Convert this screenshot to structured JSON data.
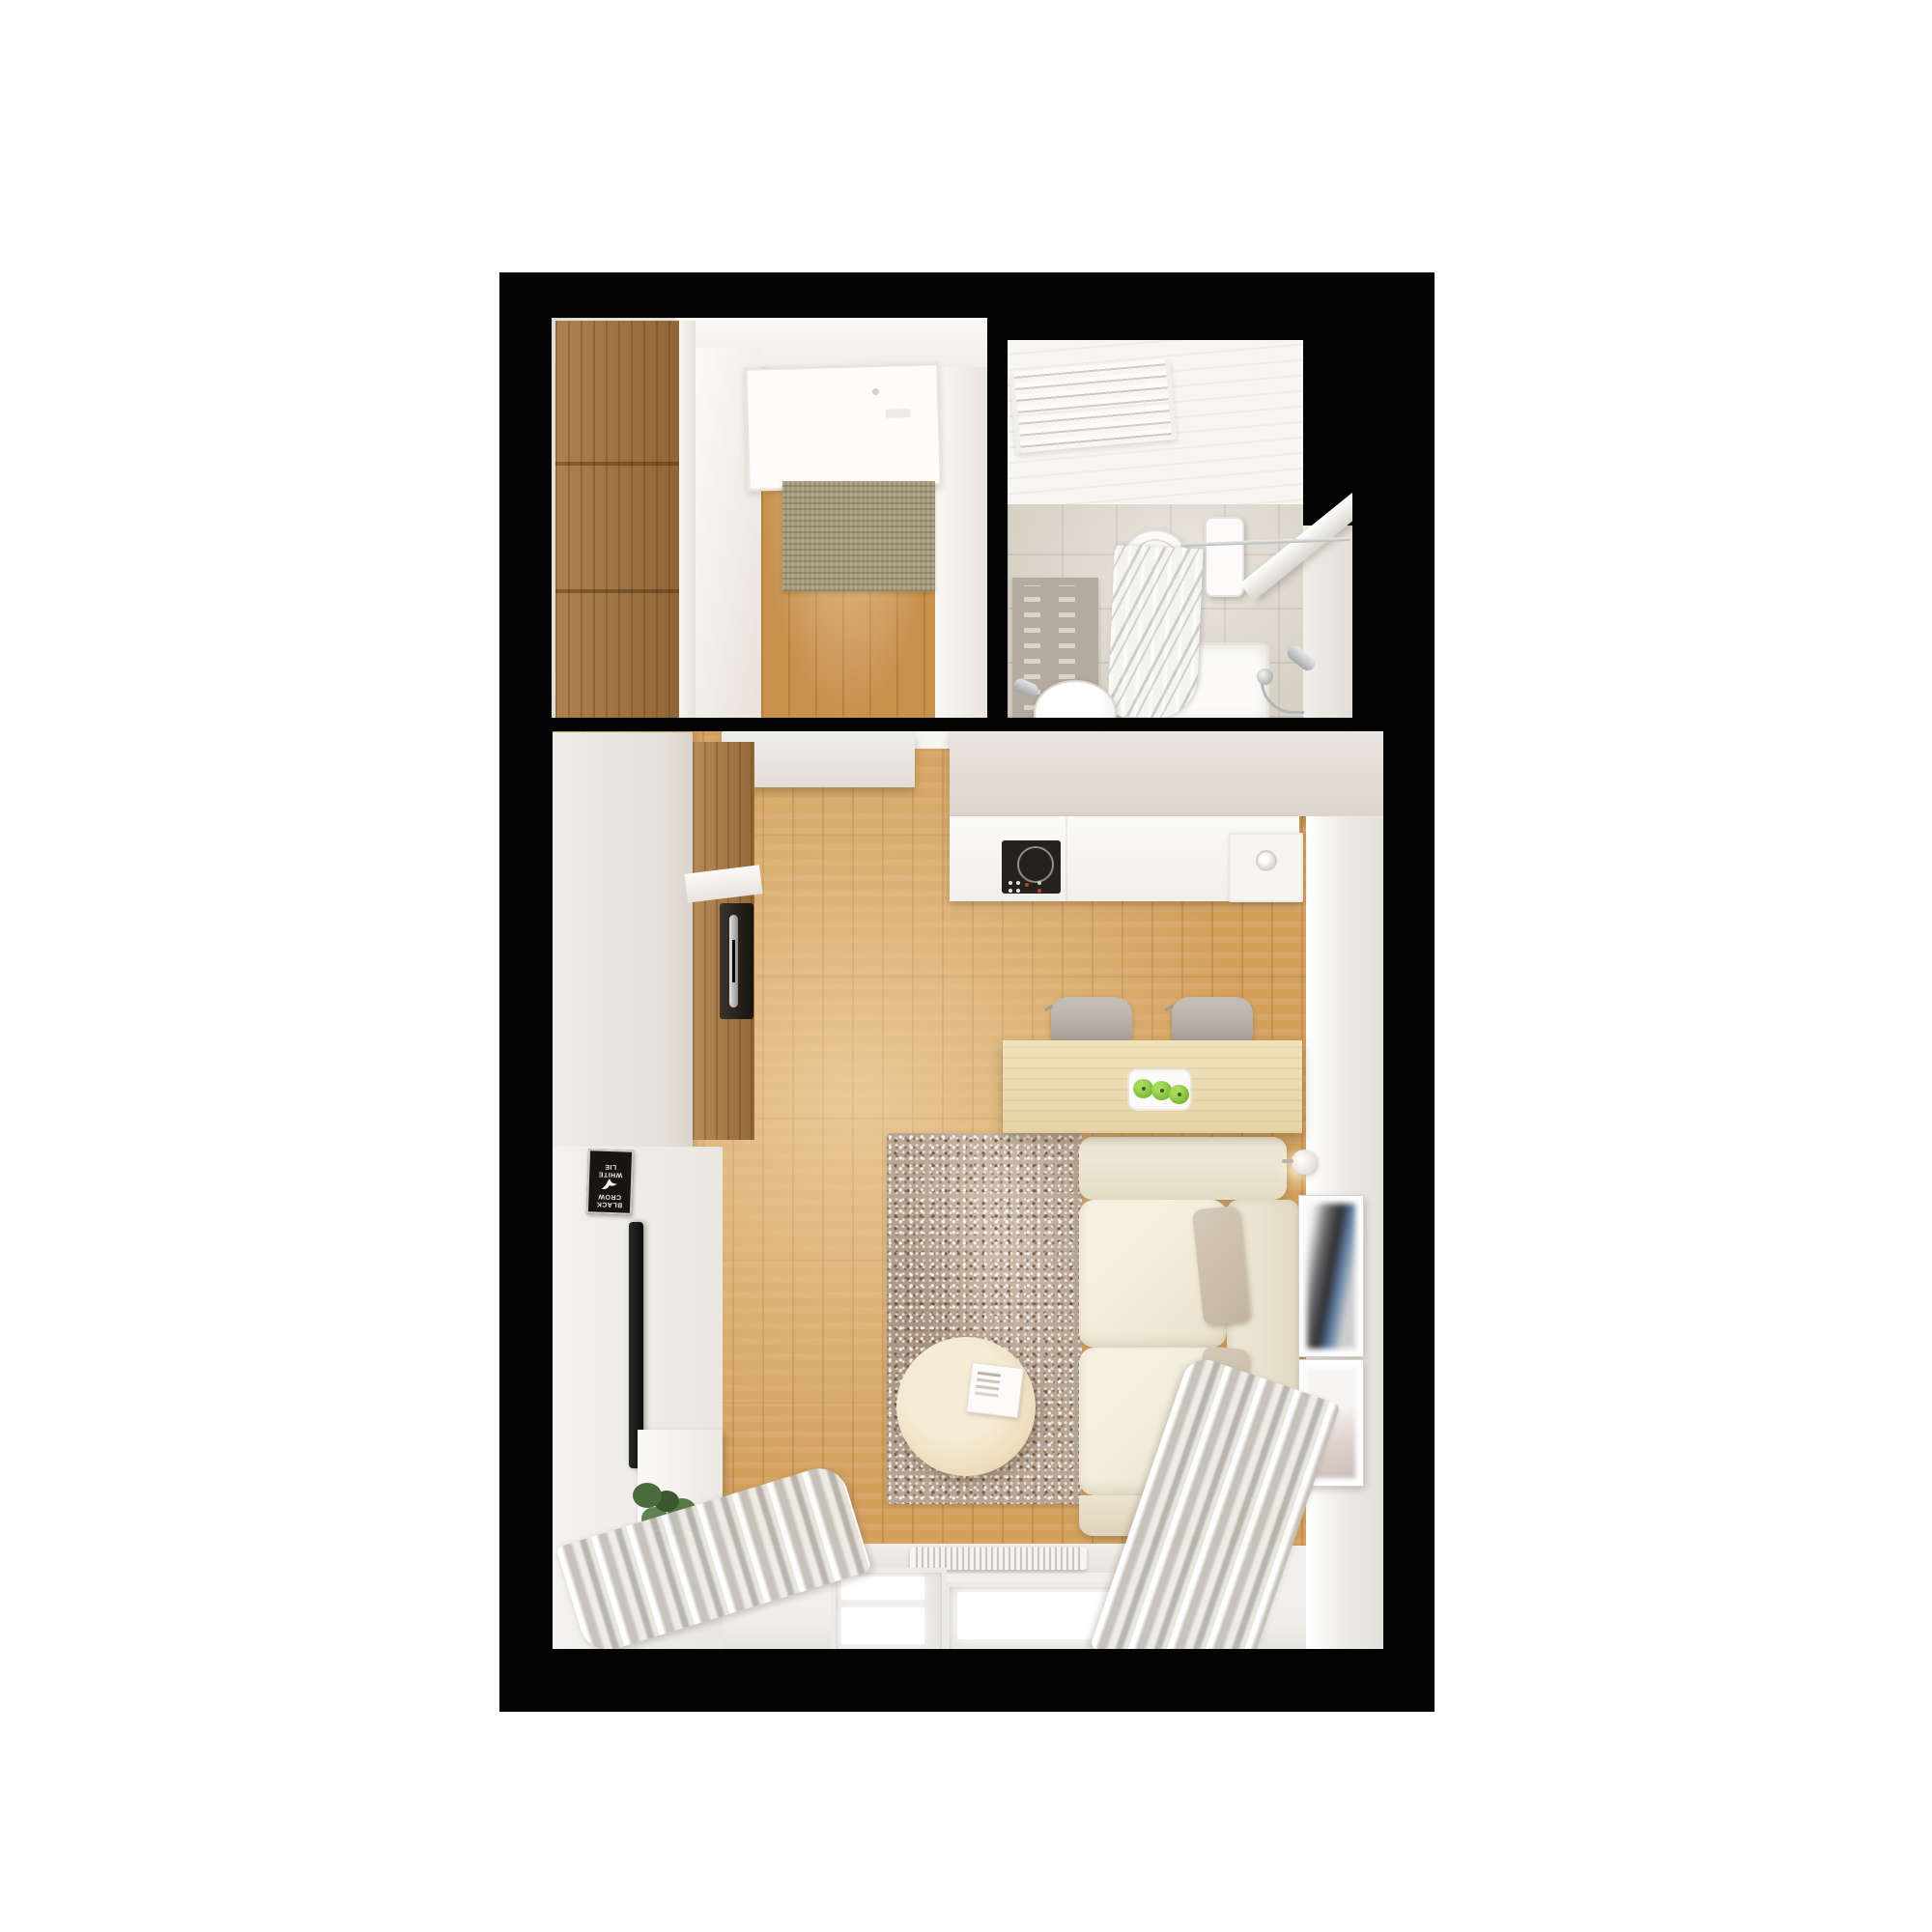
{
  "scene": {
    "title": "Studio apartment - top-down 3D floor plan render",
    "style": "photorealistic dollhouse view on white background with black wall outline",
    "background_color": "#ffffff",
    "outline_color": "#040404"
  },
  "colors": {
    "wood_floor": "#d3a05c",
    "entry_floor": "#c8914e",
    "oak_wardrobe": "#a5743c",
    "white_surfaces": "#f2f0ec",
    "kitchen_counter": "#f8f7f4",
    "cooktop": "#26211e",
    "living_rug": "#b8a695",
    "entry_mat": "#a29a79",
    "bath_mat": "#b3aaa0",
    "bath_tiles": "#d8d1c6",
    "sofa": "#f0ead9",
    "accent_pillows": "#cbbfae",
    "dining_table": "#ecdcb2",
    "chairs": "#b3aca4",
    "curtains": "#c9c5c0",
    "apples": "#7bbc35",
    "plant": "#4c6b3f"
  },
  "rooms": {
    "entry_hall": {
      "name": "Entry hall",
      "items": [
        "oak wardrobe (3 panels)",
        "white sliding doors",
        "entry door",
        "sisal doormat",
        "wood plank floor"
      ]
    },
    "bathroom": {
      "name": "Bathroom",
      "items": [
        "towel radiator",
        "toilet",
        "grey bath mat",
        "washbasin with faucet",
        "bathtub",
        "shower fixture",
        "shower curtain on rod",
        "white shelf"
      ]
    },
    "living_kitchen": {
      "name": "Living room with kitchenette",
      "items": [
        "kitchen upper cabinets",
        "range hood box",
        "counter with induction cooktop",
        "counter sink",
        "tall oak cabinet with built-in oven",
        "white wardrobe column",
        "black poster",
        "wall-mounted TV",
        "TV cabinet",
        "potted plant",
        "left grey curtain",
        "right grey curtain",
        "radiator under window",
        "two windows",
        "speckled area rug",
        "round coffee table with magazine",
        "cream sofa with two seat cushions",
        "two taupe pillows",
        "wall sconce",
        "two framed artworks",
        "dining table with apple tray",
        "two grey chairs"
      ]
    }
  },
  "poster": {
    "lines": [
      "BLACK",
      "CROW",
      "WHITE",
      "LIE"
    ]
  },
  "counts": {
    "windows": 2,
    "dining_chairs": 2,
    "apples": 3,
    "wall_frames": 2,
    "sofa_pillows": 2,
    "wardrobe_panels": 3
  }
}
